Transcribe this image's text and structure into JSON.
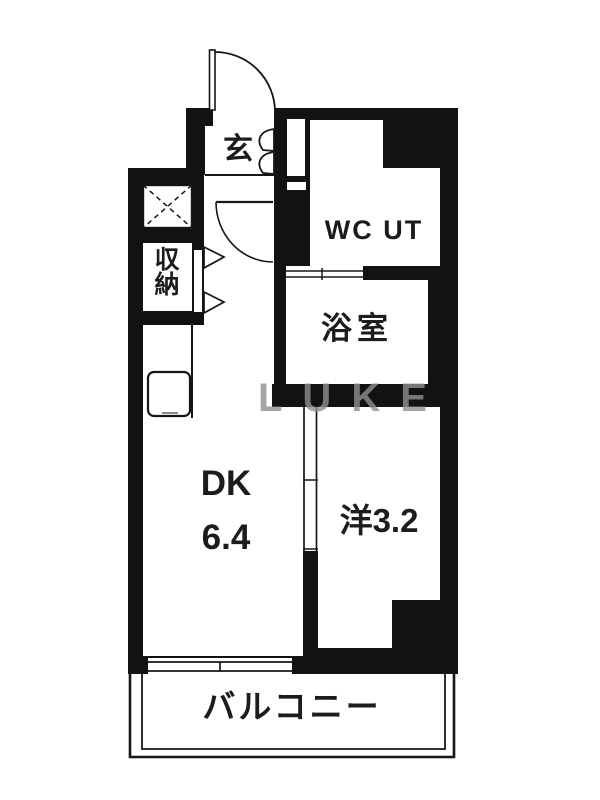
{
  "floorplan": {
    "watermark": "LUKE",
    "rooms": {
      "genkan": {
        "label": "玄"
      },
      "wc_ut": {
        "label": "WC UT"
      },
      "bath": {
        "label": "浴室"
      },
      "storage": {
        "label": "収納"
      },
      "dk": {
        "label": "DK",
        "size": "6.4"
      },
      "western": {
        "label": "洋3.2"
      },
      "balcony": {
        "label": "バルコニー"
      }
    },
    "colors": {
      "wall": "#121212",
      "floor": "#ffffff",
      "line": "#161616",
      "watermark": "#8f8f8f"
    }
  }
}
